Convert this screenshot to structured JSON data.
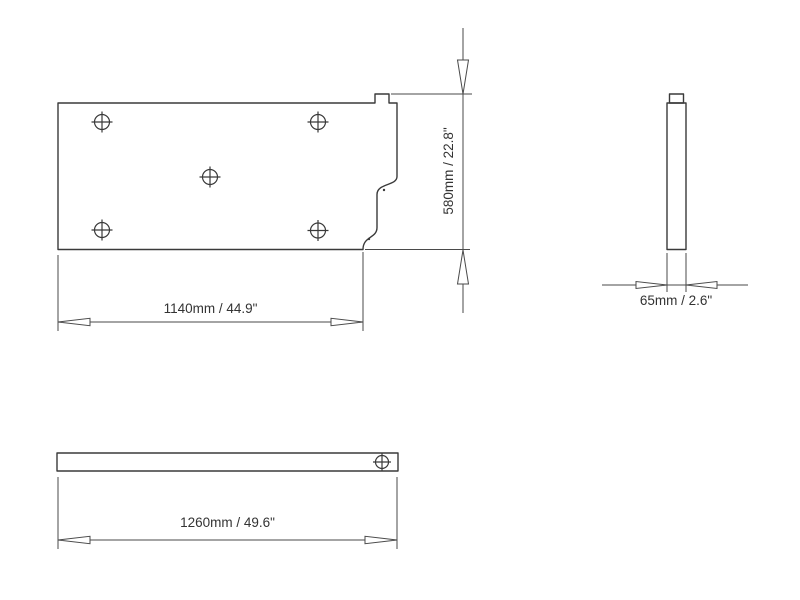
{
  "colors": {
    "background": "#ffffff",
    "line": "#3a3a3a",
    "dimension_line": "#4a4a4a",
    "text": "#333333"
  },
  "dimensions": {
    "height": {
      "label": "580mm / 22.8\""
    },
    "width_inner": {
      "label": "1140mm / 44.9\""
    },
    "thickness": {
      "label": "65mm / 2.6\""
    },
    "length": {
      "label": "1260mm / 49.6\""
    }
  }
}
